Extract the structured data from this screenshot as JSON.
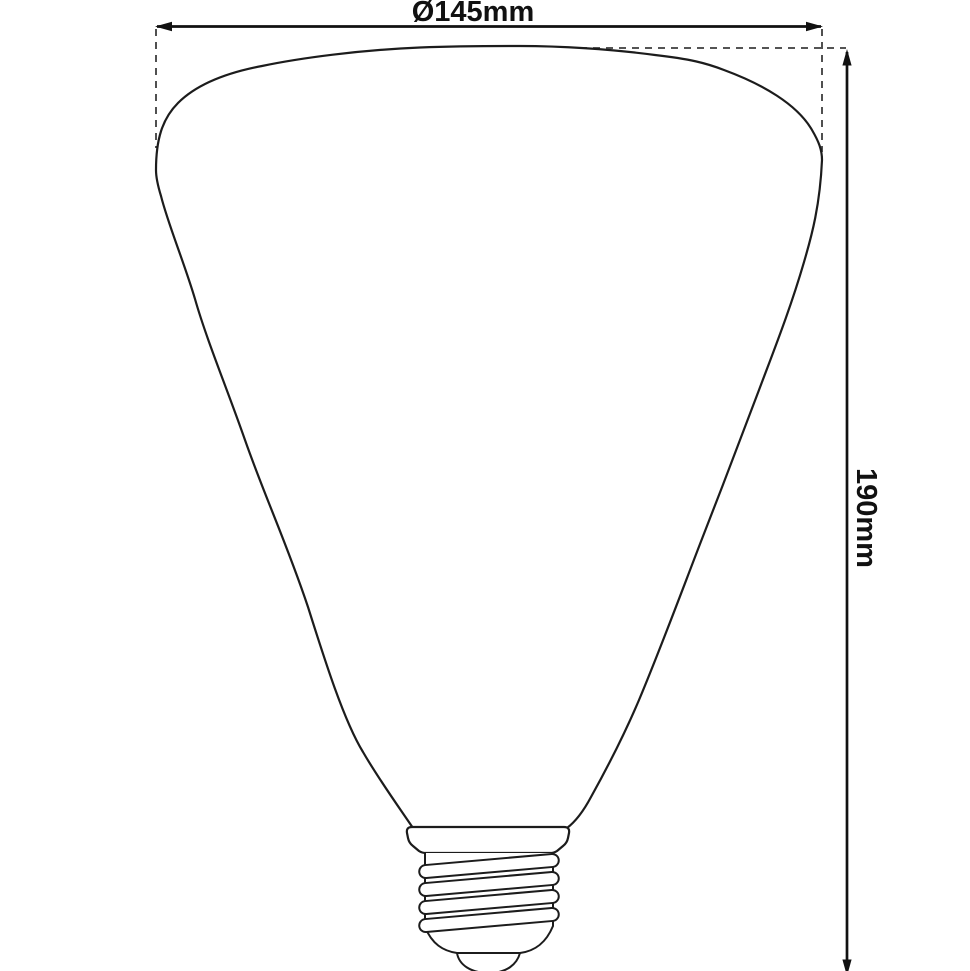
{
  "diagram": {
    "description": "Technical line drawing of a cone-shaped decorative light bulb with E27 screw base, annotated with diameter and height dimensions",
    "diameter_label": "Ø145mm",
    "height_label": "190mm",
    "dimensions": {
      "diameter_mm": 145,
      "height_mm": 190
    },
    "colors": {
      "background": "#ffffff",
      "outline": "#1c1c1c",
      "dimension_line": "#111111",
      "dashed_line": "#3d3d3d",
      "text": "#111111"
    }
  }
}
